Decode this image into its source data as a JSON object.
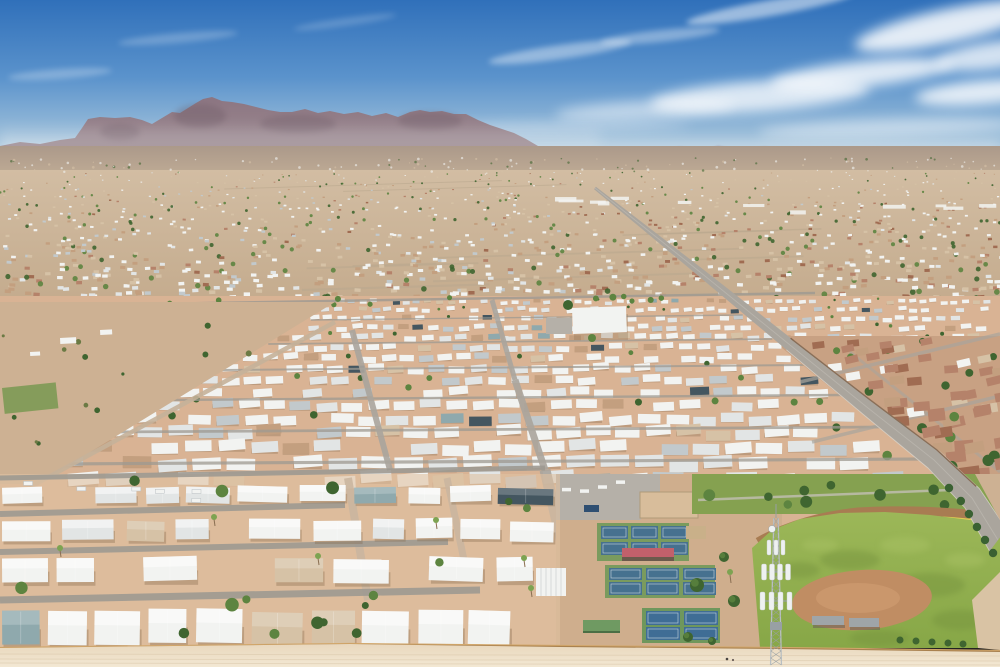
{
  "seed": 1234,
  "palette": {
    "sky_top": "#3070ba",
    "sky_mid": "#5b93cc",
    "sky_low": "#9fc0da",
    "sky_horizon": "#d5e1e9",
    "cloud": "#ffffff",
    "haze": "#eef2f5",
    "distant_ridge": "#a093a2",
    "distant_hill": "#8d7560",
    "mtn_top": "#8a7380",
    "mtn_low": "#9e8c92",
    "mtn_shadow": "#66525f",
    "bajada": "#ab998a",
    "bajada_low": "#c9b49a",
    "city_hi": "#d2bda3",
    "city_base": "#c4ab8d",
    "roof_white": "#f2f3f1",
    "roof_light": "#e2e5e5",
    "roof_gray": "#c2c9cc",
    "roof_slate": "#445660",
    "roof_teal": "#8fa9ad",
    "tan1": "#d6c2a6",
    "tan2": "#c39f7f",
    "red_roof": "#b5826a",
    "red_roof2": "#a06c52",
    "tree_dark": "#3f6530",
    "tree_mid": "#5d8440",
    "tree_light": "#7da351",
    "olive": "#6b7a44",
    "park_dirt": "#d9b394",
    "lot_dirt": "#cdb193",
    "fg_dirt": "#e0c1a2",
    "road_gray": "#aaa59d",
    "street_gray": "#9e9a92",
    "road_light": "#c6c2ba",
    "curb": "#dedad2",
    "nb_base": "#c8a183",
    "nb_wall": "#7a5a40",
    "grass_band": "#85a150",
    "field_grass": "#87a747",
    "field_grass_hi": "#9cb758",
    "field_dark": "#74923c",
    "field_light": "#a8c164",
    "infield": "#c08d63",
    "infield_hi": "#d4a276",
    "track": "#a87c52",
    "foul": "#e3d24e",
    "court_green": "#7a9b5e",
    "court_green2": "#6f975c",
    "court_blue": "#46718f",
    "court_blue2": "#3f6d95",
    "canopy_red": "#c2606b",
    "canopy_dark": "#6b5a4c",
    "shed_green": "#6f9a62",
    "pergola_tan": "#c9b089",
    "paved": "#b5b0a8",
    "sand": "#d8bd9b",
    "bin_blue": "#2e4f72",
    "wall": "#a9814f",
    "wall_hi": "#d2a76b",
    "wall_sh": "#7c5c3c",
    "bottom_dirt": "#e9d8be",
    "bottom_dirt2": "#f3e8d3",
    "streak": "#d9c6a9",
    "tower": "#b9bfc2",
    "tower_dark": "#98a0a4",
    "antenna": "#eef1f1",
    "shadow": "#8a6f52",
    "person1": "#4a4440",
    "person2": "#6b5f58"
  },
  "gradients": [
    {
      "id": "gSky",
      "y1": 0,
      "y2": 185,
      "stops": [
        [
          0,
          "sky_top"
        ],
        [
          0.42,
          "sky_mid"
        ],
        [
          0.75,
          "sky_low"
        ],
        [
          1,
          "sky_horizon"
        ]
      ]
    },
    {
      "id": "gMtn",
      "y1": 92,
      "y2": 152,
      "stops": [
        [
          0,
          "mtn_top"
        ],
        [
          1,
          "mtn_low"
        ]
      ]
    },
    {
      "id": "gBaj",
      "y1": 146,
      "y2": 190,
      "stops": [
        [
          0,
          "bajada"
        ],
        [
          1,
          "bajada_low"
        ]
      ]
    },
    {
      "id": "gCity",
      "y1": 170,
      "y2": 304,
      "stops": [
        [
          0,
          "city_hi"
        ],
        [
          1,
          "city_base"
        ]
      ]
    },
    {
      "id": "gGrass",
      "y1": 512,
      "y2": 648,
      "stops": [
        [
          0,
          "field_grass_hi"
        ],
        [
          1,
          "field_grass"
        ]
      ]
    },
    {
      "id": "gBottom",
      "y1": 645,
      "y2": 667,
      "stops": [
        [
          0,
          "bottom_dirt"
        ],
        [
          1,
          "bottom_dirt2"
        ]
      ]
    }
  ],
  "clouds": [
    {
      "x": 560,
      "y": 52,
      "rx": 72,
      "ry": 7,
      "r": -8,
      "o": 0.4,
      "s": 1
    },
    {
      "x": 660,
      "y": 36,
      "rx": 60,
      "ry": 6,
      "r": -6,
      "o": 0.35,
      "s": 1
    },
    {
      "x": 760,
      "y": 96,
      "rx": 110,
      "ry": 15,
      "r": -4,
      "o": 0.75
    },
    {
      "x": 862,
      "y": 74,
      "rx": 92,
      "ry": 13,
      "r": -6,
      "o": 0.8
    },
    {
      "x": 948,
      "y": 26,
      "rx": 95,
      "ry": 17,
      "r": -12,
      "o": 0.85
    },
    {
      "x": 985,
      "y": 92,
      "rx": 70,
      "ry": 12,
      "r": -5,
      "o": 0.8
    },
    {
      "x": 645,
      "y": 110,
      "rx": 90,
      "ry": 9,
      "r": -3,
      "o": 0.5
    },
    {
      "x": 178,
      "y": 38,
      "rx": 60,
      "ry": 5,
      "r": -5,
      "o": 0.22,
      "s": 1
    },
    {
      "x": 60,
      "y": 74,
      "rx": 52,
      "ry": 5,
      "r": -4,
      "o": 0.25,
      "s": 1
    },
    {
      "x": 345,
      "y": 22,
      "rx": 52,
      "ry": 4,
      "r": -8,
      "o": 0.18,
      "s": 1
    },
    {
      "x": 888,
      "y": 128,
      "rx": 130,
      "ry": 9,
      "r": -2,
      "o": 0.45
    },
    {
      "x": 540,
      "y": 128,
      "rx": 150,
      "ry": 7,
      "r": -1,
      "o": 0.25
    },
    {
      "x": 770,
      "y": 8,
      "rx": 85,
      "ry": 8,
      "r": -10,
      "o": 0.5,
      "s": 1
    },
    {
      "x": 995,
      "y": 55,
      "rx": 60,
      "ry": 14,
      "r": -8,
      "o": 0.75
    }
  ],
  "mountains": {
    "main": [
      [
        0,
        146
      ],
      [
        20,
        142
      ],
      [
        40,
        144
      ],
      [
        60,
        140
      ],
      [
        75,
        138
      ],
      [
        82,
        128
      ],
      [
        88,
        119
      ],
      [
        100,
        117
      ],
      [
        115,
        118
      ],
      [
        130,
        117
      ],
      [
        142,
        120
      ],
      [
        152,
        124
      ],
      [
        162,
        118
      ],
      [
        172,
        112
      ],
      [
        180,
        113
      ],
      [
        188,
        108
      ],
      [
        196,
        103
      ],
      [
        203,
        99
      ],
      [
        212,
        97
      ],
      [
        222,
        101
      ],
      [
        232,
        102
      ],
      [
        244,
        104
      ],
      [
        256,
        107
      ],
      [
        268,
        110
      ],
      [
        280,
        112
      ],
      [
        292,
        112
      ],
      [
        305,
        109
      ],
      [
        318,
        113
      ],
      [
        330,
        111
      ],
      [
        344,
        114
      ],
      [
        358,
        112
      ],
      [
        372,
        116
      ],
      [
        386,
        113
      ],
      [
        398,
        117
      ],
      [
        410,
        112
      ],
      [
        420,
        110
      ],
      [
        430,
        112
      ],
      [
        442,
        111
      ],
      [
        454,
        114
      ],
      [
        466,
        114
      ],
      [
        478,
        120
      ],
      [
        490,
        125
      ],
      [
        502,
        129
      ],
      [
        514,
        133
      ],
      [
        526,
        139
      ],
      [
        538,
        146
      ],
      [
        550,
        151
      ],
      [
        562,
        155
      ],
      [
        572,
        158
      ],
      [
        572,
        178
      ],
      [
        0,
        178
      ]
    ],
    "distant": [
      [
        520,
        160
      ],
      [
        545,
        154
      ],
      [
        575,
        151
      ],
      [
        600,
        156
      ],
      [
        625,
        149
      ],
      [
        650,
        154
      ],
      [
        680,
        147
      ],
      [
        702,
        152
      ],
      [
        718,
        146
      ],
      [
        740,
        151
      ],
      [
        765,
        147
      ],
      [
        790,
        153
      ],
      [
        815,
        149
      ],
      [
        842,
        154
      ],
      [
        868,
        150
      ],
      [
        895,
        155
      ],
      [
        918,
        150
      ],
      [
        942,
        154
      ],
      [
        966,
        151
      ],
      [
        1000,
        154
      ],
      [
        1000,
        172
      ],
      [
        520,
        172
      ]
    ],
    "hill": [
      [
        698,
        164
      ],
      [
        713,
        151
      ],
      [
        731,
        150
      ],
      [
        746,
        163
      ]
    ],
    "shade": [
      [
        200,
        116,
        26,
        12
      ],
      [
        298,
        124,
        38,
        9
      ],
      [
        430,
        121,
        32,
        9
      ],
      [
        120,
        132,
        20,
        8
      ]
    ]
  },
  "city": {
    "count": 1300,
    "y0": 172,
    "y1": 302,
    "streaks": 10,
    "strip_count": 12,
    "dots": 130
  },
  "boulevard": {
    "centers": [
      [
        595,
        188
      ],
      [
        700,
        272
      ],
      [
        790,
        345
      ],
      [
        868,
        408
      ],
      [
        934,
        460
      ],
      [
        972,
        498
      ],
      [
        998,
        540
      ]
    ],
    "halfw": [
      1.5,
      4,
      6,
      8,
      10,
      12,
      14
    ],
    "hedge_ys": [
      488,
      501,
      514,
      527,
      540,
      553
    ]
  },
  "neighborhood": {
    "poly": [
      [
        779,
        336
      ],
      [
        1000,
        336
      ],
      [
        1000,
        560
      ],
      [
        988,
        552
      ],
      [
        962,
        506
      ],
      [
        926,
        466
      ],
      [
        860,
        412
      ],
      [
        782,
        348
      ]
    ],
    "count": 200,
    "cross_streets": [
      [
        [
          800,
          382
        ],
        [
          1000,
          334
        ]
      ],
      [
        [
          812,
          442
        ],
        [
          1000,
          396
        ]
      ],
      [
        [
          830,
          506
        ],
        [
          1000,
          462
        ]
      ]
    ],
    "parallel_street": [
      [
        850,
        352
      ],
      [
        1000,
        472
      ]
    ]
  },
  "park": {
    "base": [
      0,
      296,
      1000,
      352
    ],
    "mid": {
      "y0": 300,
      "y1": 476,
      "street_ys": [
        318,
        342,
        368,
        398,
        430,
        462
      ]
    },
    "v_roads": [
      {
        "pts": [
          [
            492,
            300
          ],
          [
            515,
            380
          ],
          [
            545,
            470
          ]
        ],
        "w0": 3,
        "w1": 7
      },
      {
        "pts": [
          [
            352,
            330
          ],
          [
            390,
            470
          ]
        ],
        "w0": 2.5,
        "w1": 6
      },
      {
        "pts": [
          [
            545,
            470
          ],
          [
            566,
            560
          ],
          [
            592,
            648
          ]
        ],
        "w0": 9,
        "w1": 13
      },
      {
        "pts": [
          [
            348,
            478
          ],
          [
            368,
            600
          ]
        ],
        "w0": 7,
        "w1": 8
      },
      {
        "pts": [
          [
            447,
            478
          ],
          [
            465,
            565
          ]
        ],
        "w0": 6,
        "w1": 7
      }
    ],
    "top_street": [
      [
        150,
        304
      ],
      [
        815,
        293
      ]
    ],
    "fg_streets": [
      [
        [
          0,
          478
        ],
        [
          545,
          468
        ],
        5
      ],
      [
        [
          0,
          514
        ],
        [
          345,
          505
        ],
        6
      ],
      [
        [
          0,
          552
        ],
        [
          448,
          542
        ],
        6
      ],
      [
        [
          0,
          600
        ],
        [
          480,
          590
        ],
        7
      ]
    ],
    "fg_rows": [
      {
        "y": 486,
        "h": 16,
        "gap": 7,
        "x0": 2,
        "x1": 556,
        "skip": 0.18
      },
      {
        "y": 520,
        "h": 20,
        "gap": 8,
        "x0": 2,
        "x1": 556,
        "skip": 0.15
      },
      {
        "y": 558,
        "h": 24,
        "gap": 8,
        "x0": 2,
        "x1": 548,
        "skip": 0.12
      },
      {
        "y": 610,
        "h": 34,
        "gap": 5,
        "x0": 2,
        "x1": 545,
        "skip": 0.05
      }
    ],
    "palms": [
      [
        524,
        558
      ],
      [
        531,
        588
      ],
      [
        214,
        517
      ],
      [
        318,
        556
      ],
      [
        436,
        520
      ],
      [
        60,
        548
      ]
    ],
    "clubhouse": {
      "x": 572,
      "y": 308,
      "w": 54,
      "h": 26,
      "parking": [
        546,
        318,
        26,
        16
      ]
    },
    "pavilion": [
      536,
      568,
      30,
      28
    ]
  },
  "desert_lot": {
    "poly": [
      [
        0,
        302
      ],
      [
        335,
        302
      ],
      [
        38,
        484
      ],
      [
        0,
        484
      ]
    ],
    "green_patch": [
      2,
      388,
      54,
      26
    ],
    "road": [
      [
        30,
        487
      ],
      [
        335,
        322
      ]
    ],
    "tree_count": 14,
    "sheds": [
      [
        60,
        338,
        16,
        6
      ],
      [
        100,
        330,
        12,
        5
      ],
      [
        30,
        352,
        10,
        4
      ]
    ]
  },
  "rec": {
    "base": [
      556,
      474,
      226,
      174
    ],
    "parking": [
      [
        556,
        474
      ],
      [
        660,
        474
      ],
      [
        660,
        500
      ],
      [
        640,
        520
      ],
      [
        556,
        520
      ]
    ],
    "bin": [
      584,
      505,
      15,
      7
    ],
    "sand": [
      640,
      492,
      58,
      26
    ],
    "court_groups": [
      {
        "x": 597,
        "y": 523,
        "w": 92,
        "h": 38,
        "rows": [
          [
            526,
            13
          ],
          [
            542,
            13
          ]
        ],
        "cols": [
          [
            601,
            27
          ],
          [
            631,
            27
          ],
          [
            661,
            27
          ]
        ]
      },
      {
        "x": 605,
        "y": 565,
        "w": 110,
        "h": 33,
        "rows": [
          [
            568,
            12
          ],
          [
            582,
            13
          ]
        ],
        "cols": [
          [
            609,
            33
          ],
          [
            646,
            33
          ],
          [
            683,
            33
          ]
        ]
      },
      {
        "x": 642,
        "y": 608,
        "w": 78,
        "h": 35,
        "rows": [
          [
            611,
            14
          ],
          [
            627,
            13
          ]
        ],
        "cols": [
          [
            646,
            34
          ],
          [
            684,
            34
          ]
        ]
      }
    ],
    "canopy": [
      622,
      548,
      52,
      10
    ],
    "canopy_seats": [
      622,
      557,
      52,
      4
    ],
    "pergola": [
      686,
      526,
      20,
      13
    ],
    "shed": [
      583,
      620,
      37,
      13
    ],
    "trees": [
      [
        697,
        585,
        7
      ],
      [
        724,
        557,
        5
      ],
      [
        734,
        601,
        6
      ],
      [
        688,
        637,
        5
      ],
      [
        712,
        641,
        4
      ]
    ],
    "palm": [
      730,
      572
    ]
  },
  "park_band": {
    "rect": [
      692,
      474,
      308,
      40
    ],
    "path": [
      [
        698,
        500
      ],
      [
        950,
        490
      ]
    ],
    "tree_count": 9
  },
  "ballfield": {
    "track": "M758,542 Q 800,518 858,512 Q 930,508 1000,518",
    "foul": "M756,547 Q 800,523 858,517 Q 930,513 1000,523",
    "grass": [
      [
        752,
        548
      ],
      [
        772,
        530
      ],
      [
        800,
        519
      ],
      [
        840,
        513
      ],
      [
        885,
        512
      ],
      [
        930,
        515
      ],
      [
        970,
        520
      ],
      [
        1000,
        524
      ],
      [
        1000,
        648
      ],
      [
        760,
        648
      ]
    ],
    "mottle_dark": [
      [
        850,
        560,
        30,
        10
      ],
      [
        930,
        585,
        35,
        12
      ],
      [
        800,
        570,
        20,
        8
      ],
      [
        960,
        620,
        28,
        10
      ],
      [
        880,
        638,
        30,
        8
      ]
    ],
    "mottle_light": [
      [
        905,
        545,
        25,
        8
      ],
      [
        965,
        560,
        20,
        7
      ],
      [
        820,
        545,
        18,
        6
      ]
    ],
    "infield": {
      "cx": 862,
      "cy": 600,
      "rx": 70,
      "ry": 30,
      "rot": -4
    },
    "dugouts": [
      [
        812,
        616,
        32,
        9
      ],
      [
        849,
        618,
        30,
        9
      ]
    ],
    "bushes": [
      [
        900,
        640
      ],
      [
        916,
        641
      ],
      [
        932,
        642
      ],
      [
        948,
        643
      ],
      [
        963,
        644
      ]
    ]
  },
  "wall": {
    "segs": [
      [
        [
          0,
          649
        ],
        [
          350,
          645
        ]
      ],
      [
        [
          350,
          645
        ],
        [
          560,
          647
        ]
      ],
      [
        [
          560,
          647
        ],
        [
          780,
          649
        ]
      ],
      [
        [
          780,
          649
        ],
        [
          1000,
          652
        ]
      ]
    ]
  },
  "bottom": {
    "poly": [
      [
        0,
        648
      ],
      [
        350,
        644
      ],
      [
        560,
        647
      ],
      [
        780,
        649
      ],
      [
        1000,
        652
      ],
      [
        1000,
        667
      ],
      [
        0,
        667
      ]
    ],
    "streak_ys": [
      654,
      659,
      663
    ],
    "people": [
      [
        727,
        659,
        1.3
      ],
      [
        733,
        660,
        1.1
      ]
    ]
  },
  "tower": {
    "cx": 776,
    "top": 518,
    "bottom": 667,
    "spike_top": 504,
    "clusters": [
      {
        "y": 524,
        "type": "dish"
      },
      {
        "y": 540,
        "type": "panels",
        "n": 3,
        "w": 4,
        "h": 15,
        "spread": 7
      },
      {
        "y": 564,
        "type": "panels",
        "n": 4,
        "w": 5,
        "h": 16,
        "spread": 8,
        "beam": true
      },
      {
        "y": 592,
        "type": "panels",
        "n": 4,
        "w": 5,
        "h": 18,
        "spread": 9,
        "beam": true
      },
      {
        "y": 622,
        "type": "box"
      }
    ]
  }
}
